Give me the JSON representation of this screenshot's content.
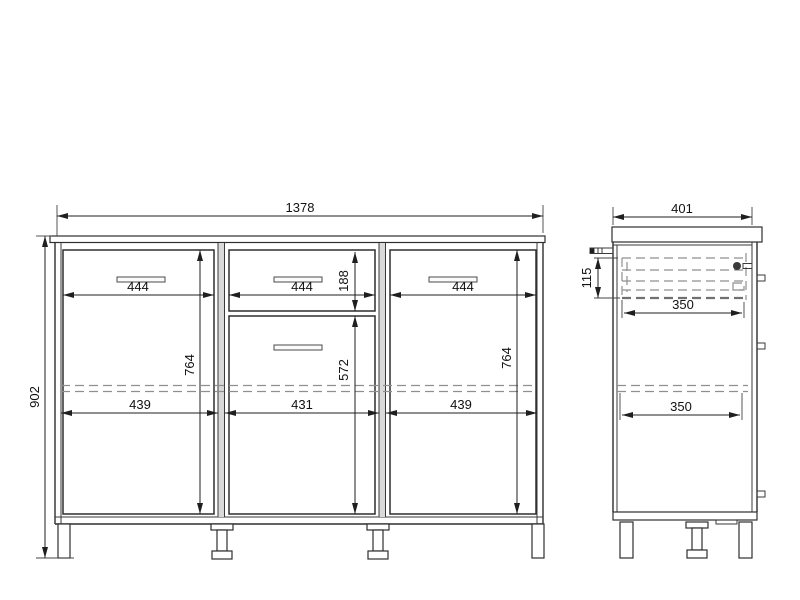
{
  "drawing": {
    "subject": "sideboard-cabinet-technical-drawing",
    "units": "mm",
    "front": {
      "overall_width": "1378",
      "overall_height": "902",
      "left_door_width": "444",
      "drawer_width": "444",
      "right_door_width": "444",
      "drawer_front_height": "188",
      "left_door_height": "764",
      "middle_door_height": "572",
      "right_door_height": "764",
      "left_bay_width": "439",
      "middle_bay_width": "431",
      "right_bay_width": "439"
    },
    "side": {
      "overall_depth": "401",
      "drawer_box_height": "115",
      "drawer_depth": "350",
      "shelf_depth": "350"
    }
  }
}
